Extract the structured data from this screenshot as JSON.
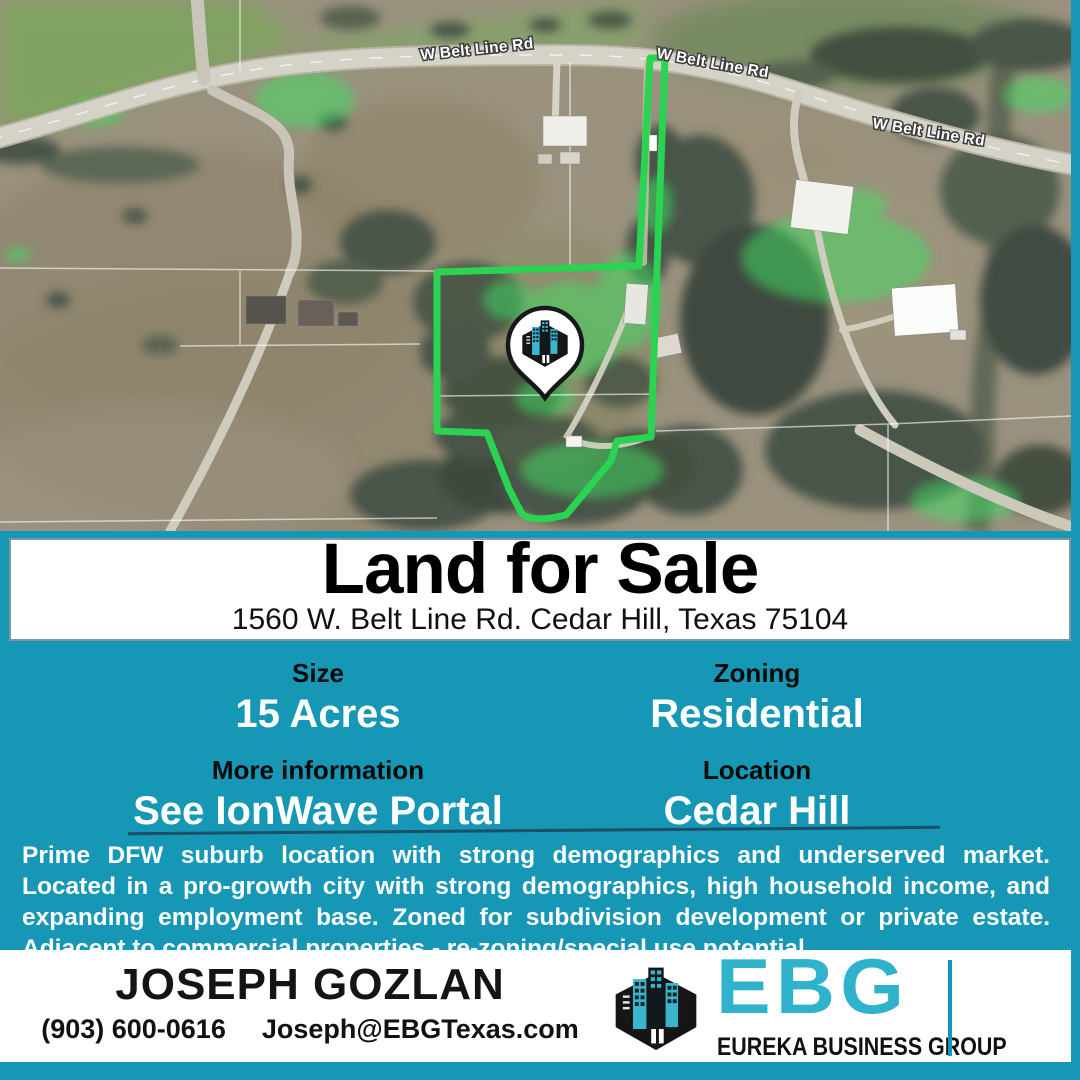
{
  "banner": {
    "title": "Land for Sale",
    "address": "1560 W. Belt Line Rd. Cedar Hill, Texas 75104"
  },
  "info": {
    "columns": [
      {
        "pairs": [
          {
            "label": "Size",
            "value": "15 Acres"
          },
          {
            "label": "More information",
            "value": "See IonWave Portal"
          }
        ]
      },
      {
        "pairs": [
          {
            "label": "Zoning",
            "value": "Residential"
          },
          {
            "label": "Location",
            "value": "Cedar Hill"
          }
        ]
      }
    ]
  },
  "description": "Prime DFW suburb location with strong demographics and underserved market. Located in a pro-growth city with strong demographics, high household income, and expanding employment base. Zoned for subdivision development or private estate. Adjacent to commercial properties - re-zoning/special use potential.",
  "contact": {
    "name": "JOSEPH GOZLAN",
    "phone": "(903) 600-0616",
    "email": "Joseph@EBGTexas.com"
  },
  "brand": {
    "letters": "EBG",
    "tagline": "EUREKA BUSINESS GROUP"
  },
  "map": {
    "road_labels": [
      "W Belt Line Rd",
      "W Belt Line Rd",
      "W Belt Line Rd"
    ],
    "pin_icon": "ebg-buildings-logo-pin"
  },
  "colors": {
    "teal_background": "#1697b5",
    "brand_teal": "#2fb2cb",
    "boundary_green": "#2bd352",
    "highlight_green": "#3fe063"
  }
}
